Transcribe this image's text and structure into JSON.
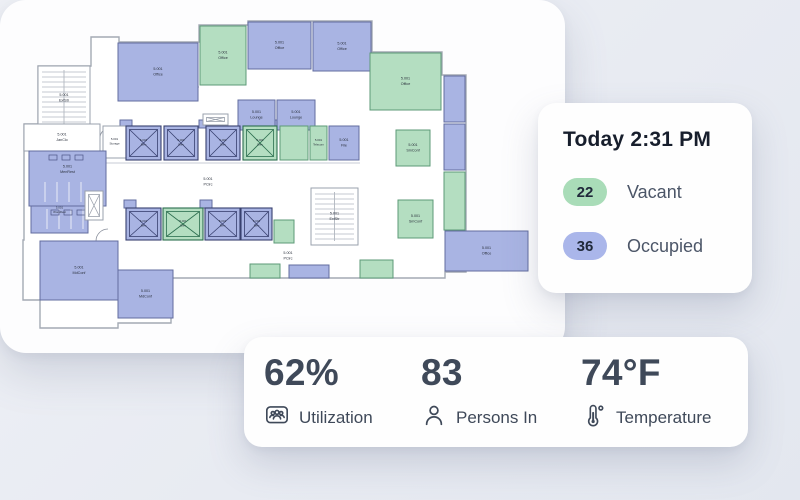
{
  "status_card": {
    "title": "Today 2:31 PM",
    "rows": [
      {
        "value": "22",
        "label": "Vacant",
        "pill_bg": "#a9dcb8"
      },
      {
        "value": "36",
        "label": "Occupied",
        "pill_bg": "#aab6ea"
      }
    ]
  },
  "metrics_card": {
    "metrics": [
      {
        "value": "62%",
        "label": "Utilization",
        "icon": "people-badge-icon"
      },
      {
        "value": "83",
        "label": "Persons In",
        "icon": "person-icon"
      },
      {
        "value": "74°F",
        "label": "Temperature",
        "icon": "thermometer-icon"
      }
    ]
  },
  "floor_plan": {
    "floor_code": "5.001",
    "status_colors": {
      "occupied": {
        "fill": "#a9b4e3",
        "stroke": "#626c9f",
        "elev": "#38406f"
      },
      "vacant": {
        "fill": "#b4dec1",
        "stroke": "#5d9a77",
        "elev": "#2c6e4f"
      },
      "neutral": {
        "fill": "#ffffff",
        "stroke": "#9aa1ac",
        "elev": "#9aa1ac"
      }
    },
    "label_color": "#2b313d",
    "wall_color": "#a4aab4",
    "perimeter_path": "M 38,66 L 91,66 L 91,37 L 119,37 L 119,42 L 199,42 L 199,25 L 248,25 L 248,21 L 372,21 L 372,52 L 442,52 L 442,75 L 466,75 L 466,272 L 445,272 L 445,278 L 171,278 L 171,323 L 118,323 L 118,328 L 40,328 L 40,300 L 23,300 L 23,240 L 24,240 L 24,124 L 38,124 Z",
    "corridor_lines": [
      {
        "x1": 100,
        "y1": 163,
        "x2": 360,
        "y2": 163
      },
      {
        "x1": 100,
        "y1": 124,
        "x2": 100,
        "y2": 163
      }
    ],
    "door_arcs": [
      "M 185,101 A 14,14 0 0 1 199,87",
      "M 214,85 A 12,12 0 0 1 226,73",
      "M 268,69 A 12,12 0 0 1 280,57",
      "M 334,71 A 12,12 0 0 1 346,59",
      "M 383,53 A 13,13 0 0 1 370,66",
      "M 96,241 A 12,12 0 0 1 108,229",
      "M 341,160 A 11,11 0 0 1 352,149",
      "M 419,159 A 11,11 0 0 1 430,148",
      "M 100,138 A 10,10 0 0 1 110,128"
    ],
    "circulation_labels": [
      {
        "text": "PCirc",
        "x": 208,
        "y": 181
      },
      {
        "text": "PCirc",
        "x": 288,
        "y": 255
      }
    ],
    "rooms": [
      {
        "name": "",
        "status": "occupied",
        "x": 120,
        "y": 120,
        "w": 12,
        "h": 8
      },
      {
        "name": "",
        "status": "occupied",
        "x": 199,
        "y": 120,
        "w": 12,
        "h": 8
      },
      {
        "name": "",
        "status": "occupied",
        "x": 271,
        "y": 120,
        "w": 12,
        "h": 8
      },
      {
        "name": "",
        "status": "occupied",
        "x": 124,
        "y": 200,
        "w": 12,
        "h": 8
      },
      {
        "name": "",
        "status": "occupied",
        "x": 200,
        "y": 200,
        "w": 12,
        "h": 8
      },
      {
        "name": "Office",
        "status": "occupied",
        "x": 118,
        "y": 43,
        "w": 80,
        "h": 58
      },
      {
        "name": "Office",
        "status": "vacant",
        "x": 200,
        "y": 26,
        "w": 46,
        "h": 59
      },
      {
        "name": "Office",
        "status": "occupied",
        "x": 248,
        "y": 22,
        "w": 63,
        "h": 47
      },
      {
        "name": "Office",
        "status": "occupied",
        "x": 313,
        "y": 22,
        "w": 58,
        "h": 49
      },
      {
        "name": "Office",
        "status": "vacant",
        "x": 370,
        "y": 53,
        "w": 71,
        "h": 57
      },
      {
        "name": "Lounge",
        "status": "occupied",
        "x": 238,
        "y": 100,
        "w": 37,
        "h": 30
      },
      {
        "name": "Lounge",
        "status": "occupied",
        "x": 277,
        "y": 100,
        "w": 38,
        "h": 30
      },
      {
        "name": "Storage",
        "status": "neutral",
        "x": 103,
        "y": 126,
        "w": 23,
        "h": 32,
        "small": true
      },
      {
        "name": "Elev",
        "status": "occupied",
        "kind": "elevator",
        "x": 126,
        "y": 126,
        "w": 35,
        "h": 34
      },
      {
        "name": "Elev",
        "status": "occupied",
        "kind": "elevator",
        "x": 164,
        "y": 126,
        "w": 34,
        "h": 34
      },
      {
        "name": "Elev",
        "status": "occupied",
        "kind": "elevator",
        "x": 206,
        "y": 126,
        "w": 34,
        "h": 34
      },
      {
        "name": "Elev",
        "status": "vacant",
        "kind": "elevator",
        "x": 243,
        "y": 126,
        "w": 34,
        "h": 34
      },
      {
        "name": "",
        "status": "vacant",
        "x": 280,
        "y": 126,
        "w": 28,
        "h": 34
      },
      {
        "name": "Telecom",
        "status": "vacant",
        "x": 310,
        "y": 126,
        "w": 17,
        "h": 34,
        "small": true
      },
      {
        "name": "File",
        "status": "occupied",
        "x": 329,
        "y": 126,
        "w": 30,
        "h": 34
      },
      {
        "name": "SmConf",
        "status": "vacant",
        "x": 396,
        "y": 130,
        "w": 34,
        "h": 36
      },
      {
        "name": "",
        "status": "occupied",
        "x": 444,
        "y": 76,
        "w": 21,
        "h": 46
      },
      {
        "name": "",
        "status": "occupied",
        "x": 444,
        "y": 124,
        "w": 21,
        "h": 46
      },
      {
        "name": "",
        "status": "vacant",
        "x": 444,
        "y": 172,
        "w": 21,
        "h": 58
      },
      {
        "name": "ExtStr",
        "status": "neutral",
        "kind": "stairs",
        "x": 38,
        "y": 66,
        "w": 52,
        "h": 64
      },
      {
        "name": "JanClo",
        "status": "neutral",
        "x": 24,
        "y": 124,
        "w": 76,
        "h": 27
      },
      {
        "name": "MenRest",
        "status": "occupied",
        "kind": "restroom",
        "x": 29,
        "y": 151,
        "w": 77,
        "h": 55
      },
      {
        "name": "WomRest",
        "status": "occupied",
        "kind": "restroom",
        "x": 31,
        "y": 206,
        "w": 57,
        "h": 27,
        "small": true
      },
      {
        "name": "",
        "status": "neutral",
        "kind": "shaft",
        "x": 85,
        "y": 191,
        "w": 18,
        "h": 29
      },
      {
        "name": "MdConf",
        "status": "occupied",
        "x": 40,
        "y": 241,
        "w": 78,
        "h": 59
      },
      {
        "name": "MdConf",
        "status": "occupied",
        "x": 118,
        "y": 270,
        "w": 55,
        "h": 48
      },
      {
        "name": "Elev",
        "status": "occupied",
        "kind": "elevator",
        "x": 126,
        "y": 208,
        "w": 35,
        "h": 32
      },
      {
        "name": "Elev",
        "status": "vacant",
        "kind": "elevator",
        "x": 163,
        "y": 208,
        "w": 40,
        "h": 32
      },
      {
        "name": "Elev",
        "status": "occupied",
        "kind": "elevator",
        "x": 205,
        "y": 208,
        "w": 35,
        "h": 32
      },
      {
        "name": "Elev",
        "status": "occupied",
        "kind": "elevator",
        "x": 241,
        "y": 208,
        "w": 31,
        "h": 32
      },
      {
        "name": "",
        "status": "vacant",
        "x": 274,
        "y": 220,
        "w": 20,
        "h": 23
      },
      {
        "name": "ExtStr",
        "status": "neutral",
        "kind": "stairs",
        "x": 311,
        "y": 188,
        "w": 47,
        "h": 57
      },
      {
        "name": "SmConf",
        "status": "vacant",
        "x": 398,
        "y": 200,
        "w": 35,
        "h": 38
      },
      {
        "name": "Office",
        "status": "occupied",
        "x": 445,
        "y": 231,
        "w": 83,
        "h": 40
      },
      {
        "name": "",
        "status": "vacant",
        "x": 250,
        "y": 264,
        "w": 30,
        "h": 14
      },
      {
        "name": "",
        "status": "occupied",
        "x": 289,
        "y": 265,
        "w": 40,
        "h": 13
      },
      {
        "name": "",
        "status": "vacant",
        "x": 360,
        "y": 260,
        "w": 33,
        "h": 18
      },
      {
        "name": "",
        "status": "neutral",
        "kind": "shaft",
        "x": 203,
        "y": 114,
        "w": 25,
        "h": 11
      }
    ]
  }
}
